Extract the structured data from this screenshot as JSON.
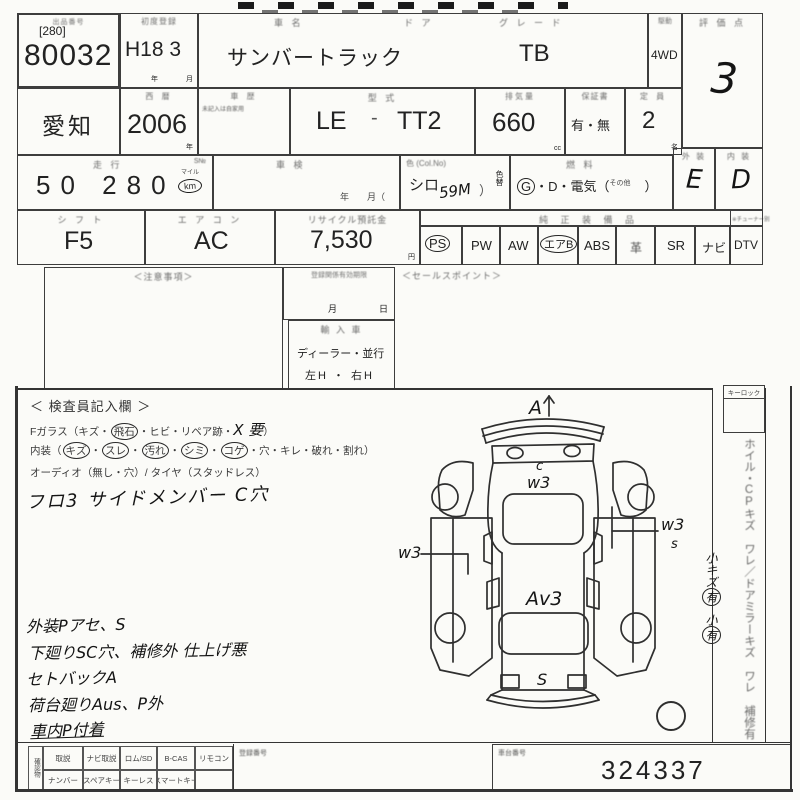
{
  "table": {
    "lot": {
      "label": "出品番号",
      "bracket": "[280]",
      "number": "80032"
    },
    "first_reg": {
      "label": "初度登録",
      "value": "H18 3",
      "unit_y": "年",
      "unit_m": "月"
    },
    "name": {
      "label": "車  名",
      "value": "サンバートラック"
    },
    "door": {
      "label": "ド ア"
    },
    "grade": {
      "label": "グ レ ー ド",
      "value": "TB"
    },
    "drive": {
      "label": "駆動",
      "value": "4WD"
    },
    "score": {
      "label": "評 価 点",
      "value": "3"
    },
    "prefecture": {
      "value": "愛知"
    },
    "year": {
      "label": "西 暦",
      "value": "2006",
      "unit": "年"
    },
    "history": {
      "label": "車 歴",
      "note": "未記入は自家用"
    },
    "model": {
      "label": "型  式",
      "value_a": "LE",
      "dash": "-",
      "value_b": "TT2"
    },
    "displacement": {
      "label": "排気量",
      "value": "660",
      "unit": "cc"
    },
    "warranty": {
      "label": "保証書",
      "value": "有・無"
    },
    "capacity": {
      "label": "定 員",
      "value": "2",
      "unit": "名"
    },
    "mileage": {
      "label": "走  行",
      "sno": "S№",
      "value": "50 280",
      "unit_top": "マイル",
      "unit": "km"
    },
    "shaken": {
      "label": "車  検",
      "units": "年　　月（"
    },
    "color": {
      "label": "色 (Col.No)",
      "value": "シロ",
      "hw_code": "59M",
      "paren": "）",
      "change_label": "色替"
    },
    "fuel": {
      "label": "燃  料",
      "g": "G",
      "rest": "・D・電気（",
      "other": "その他",
      "close": "）"
    },
    "exterior": {
      "label": "外 装",
      "value": "E"
    },
    "interior": {
      "label": "内 装",
      "value": "D"
    },
    "shift": {
      "label": "シ フ ト",
      "value": "F5"
    },
    "aircon": {
      "label": "エ ア コ ン",
      "value": "AC"
    },
    "recycle": {
      "label": "リサイクル預託金",
      "value": "7,530",
      "unit": "円"
    }
  },
  "equipment": {
    "label": "純 正 装 備 品",
    "tuner_note": "※チューナー別",
    "items": [
      {
        "label": "PS",
        "circled": true
      },
      {
        "label": "PW",
        "circled": false
      },
      {
        "label": "AW",
        "circled": false
      },
      {
        "label": "エアB",
        "circled": true
      },
      {
        "label": "ABS",
        "circled": false
      },
      {
        "label": "革",
        "circled": false
      },
      {
        "label": "SR",
        "circled": false
      },
      {
        "label": "ナビ",
        "circled": false
      },
      {
        "label": "DTV",
        "circled": false
      }
    ]
  },
  "mid": {
    "notes_label": "＜注意事項＞",
    "reg_expiry": {
      "label": "登録関係有効期限",
      "month": "月",
      "day": "日"
    },
    "import": {
      "label": "輸 入 車",
      "line1": "ディーラー・並行",
      "line2": "左H ・ 右H"
    },
    "sales_label": "＜セールスポイント＞"
  },
  "inspection": {
    "title": "＜ 検査員記入欄 ＞",
    "sep": "・",
    "glass_prefix": "Fガラス（キズ・",
    "glass_circled": "飛石",
    "glass_mid": "・ヒビ・リペア跡・",
    "glass_hw": "X 要",
    "glass_suffix": "）",
    "interior_prefix": "内装（",
    "interior_circled": [
      "キズ",
      "スレ",
      "汚れ",
      "シミ",
      "コゲ"
    ],
    "interior_rest": "・穴・キレ・破れ・割れ）",
    "audio_line": "オーディオ（無し・穴）/ タイヤ（スタッドレス）",
    "member_note": "フロ3 サイドメンバー C穴",
    "remarks": [
      "外装Pアセ、S",
      "下廻りSC穴、補修外 仕上げ悪",
      "セトバックA",
      "荷台廻りAus、P外",
      "車内P付着"
    ]
  },
  "diagram": {
    "front": "A",
    "cab_c": "c",
    "cab_w3": "w3",
    "left_w3": "w3",
    "right_w3": "w3",
    "right_s": "s",
    "bed": "Av3",
    "rear": "S"
  },
  "sidebar": {
    "keylock": "キーロック",
    "note_main": "ホイル・CPキズ ワレ／ドアミラーキズ ワレ 補修有",
    "small1": "小キズ",
    "small1_c": "有",
    "small2": "小",
    "small2_c": "有"
  },
  "bottom": {
    "vlabel": "確認物",
    "row1": [
      "取説",
      "ナビ取説",
      "ロム/SD",
      "B-CAS",
      "リモコン"
    ],
    "row2": [
      "ナンバー",
      "スペアキー",
      "キーレス",
      "スマートキー"
    ],
    "reg_label": "登録番号",
    "chassis": {
      "label": "車台番号",
      "value": "324337"
    }
  }
}
